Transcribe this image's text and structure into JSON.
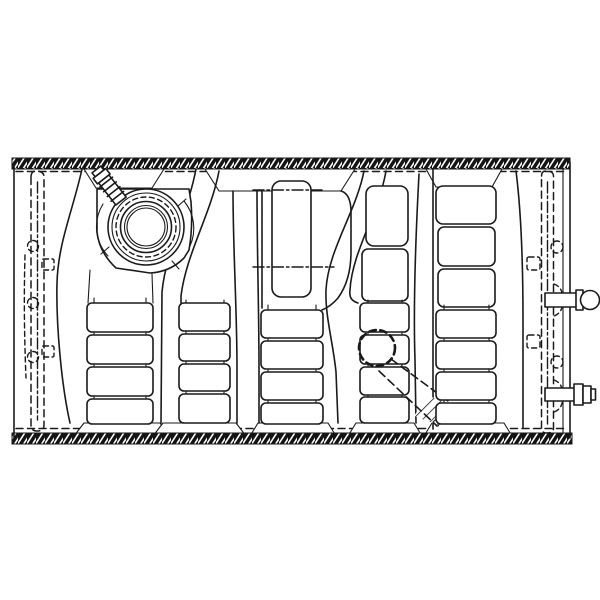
{
  "canvas": {
    "width": 600,
    "height": 600,
    "background_color": "#ffffff",
    "line_color": "#1a1a1a"
  },
  "diagram": {
    "type": "technical-line-drawing",
    "subject": "Fuel tank assembly, top view line illustration",
    "style": "black ink parts-catalog drawing on white, no text labels",
    "components": {
      "tank_body": "rectangular fuel tank shell with hatched crimp seam flanges on top and bottom edges",
      "filler_cap": "concentric-ring filler cap and flange, upper left",
      "vent_nozzle": "ribbed vent hose barb angled up-left from filler flange",
      "ribs": "five columns of stamped stiffening ribs separated by S-curved channels",
      "access_plate": "rounded rectangular plate with center-line marks, top center",
      "hidden_straps": "dashed mounting straps with bolt holes along left and right ends",
      "hidden_pipe": "dashed internal pickup pipe with circular port, lower right of center",
      "fittings": "two hose fittings protruding from the right end"
    },
    "counts": {
      "rib_columns": 5,
      "hose_fittings": 2,
      "straps": 2
    }
  }
}
